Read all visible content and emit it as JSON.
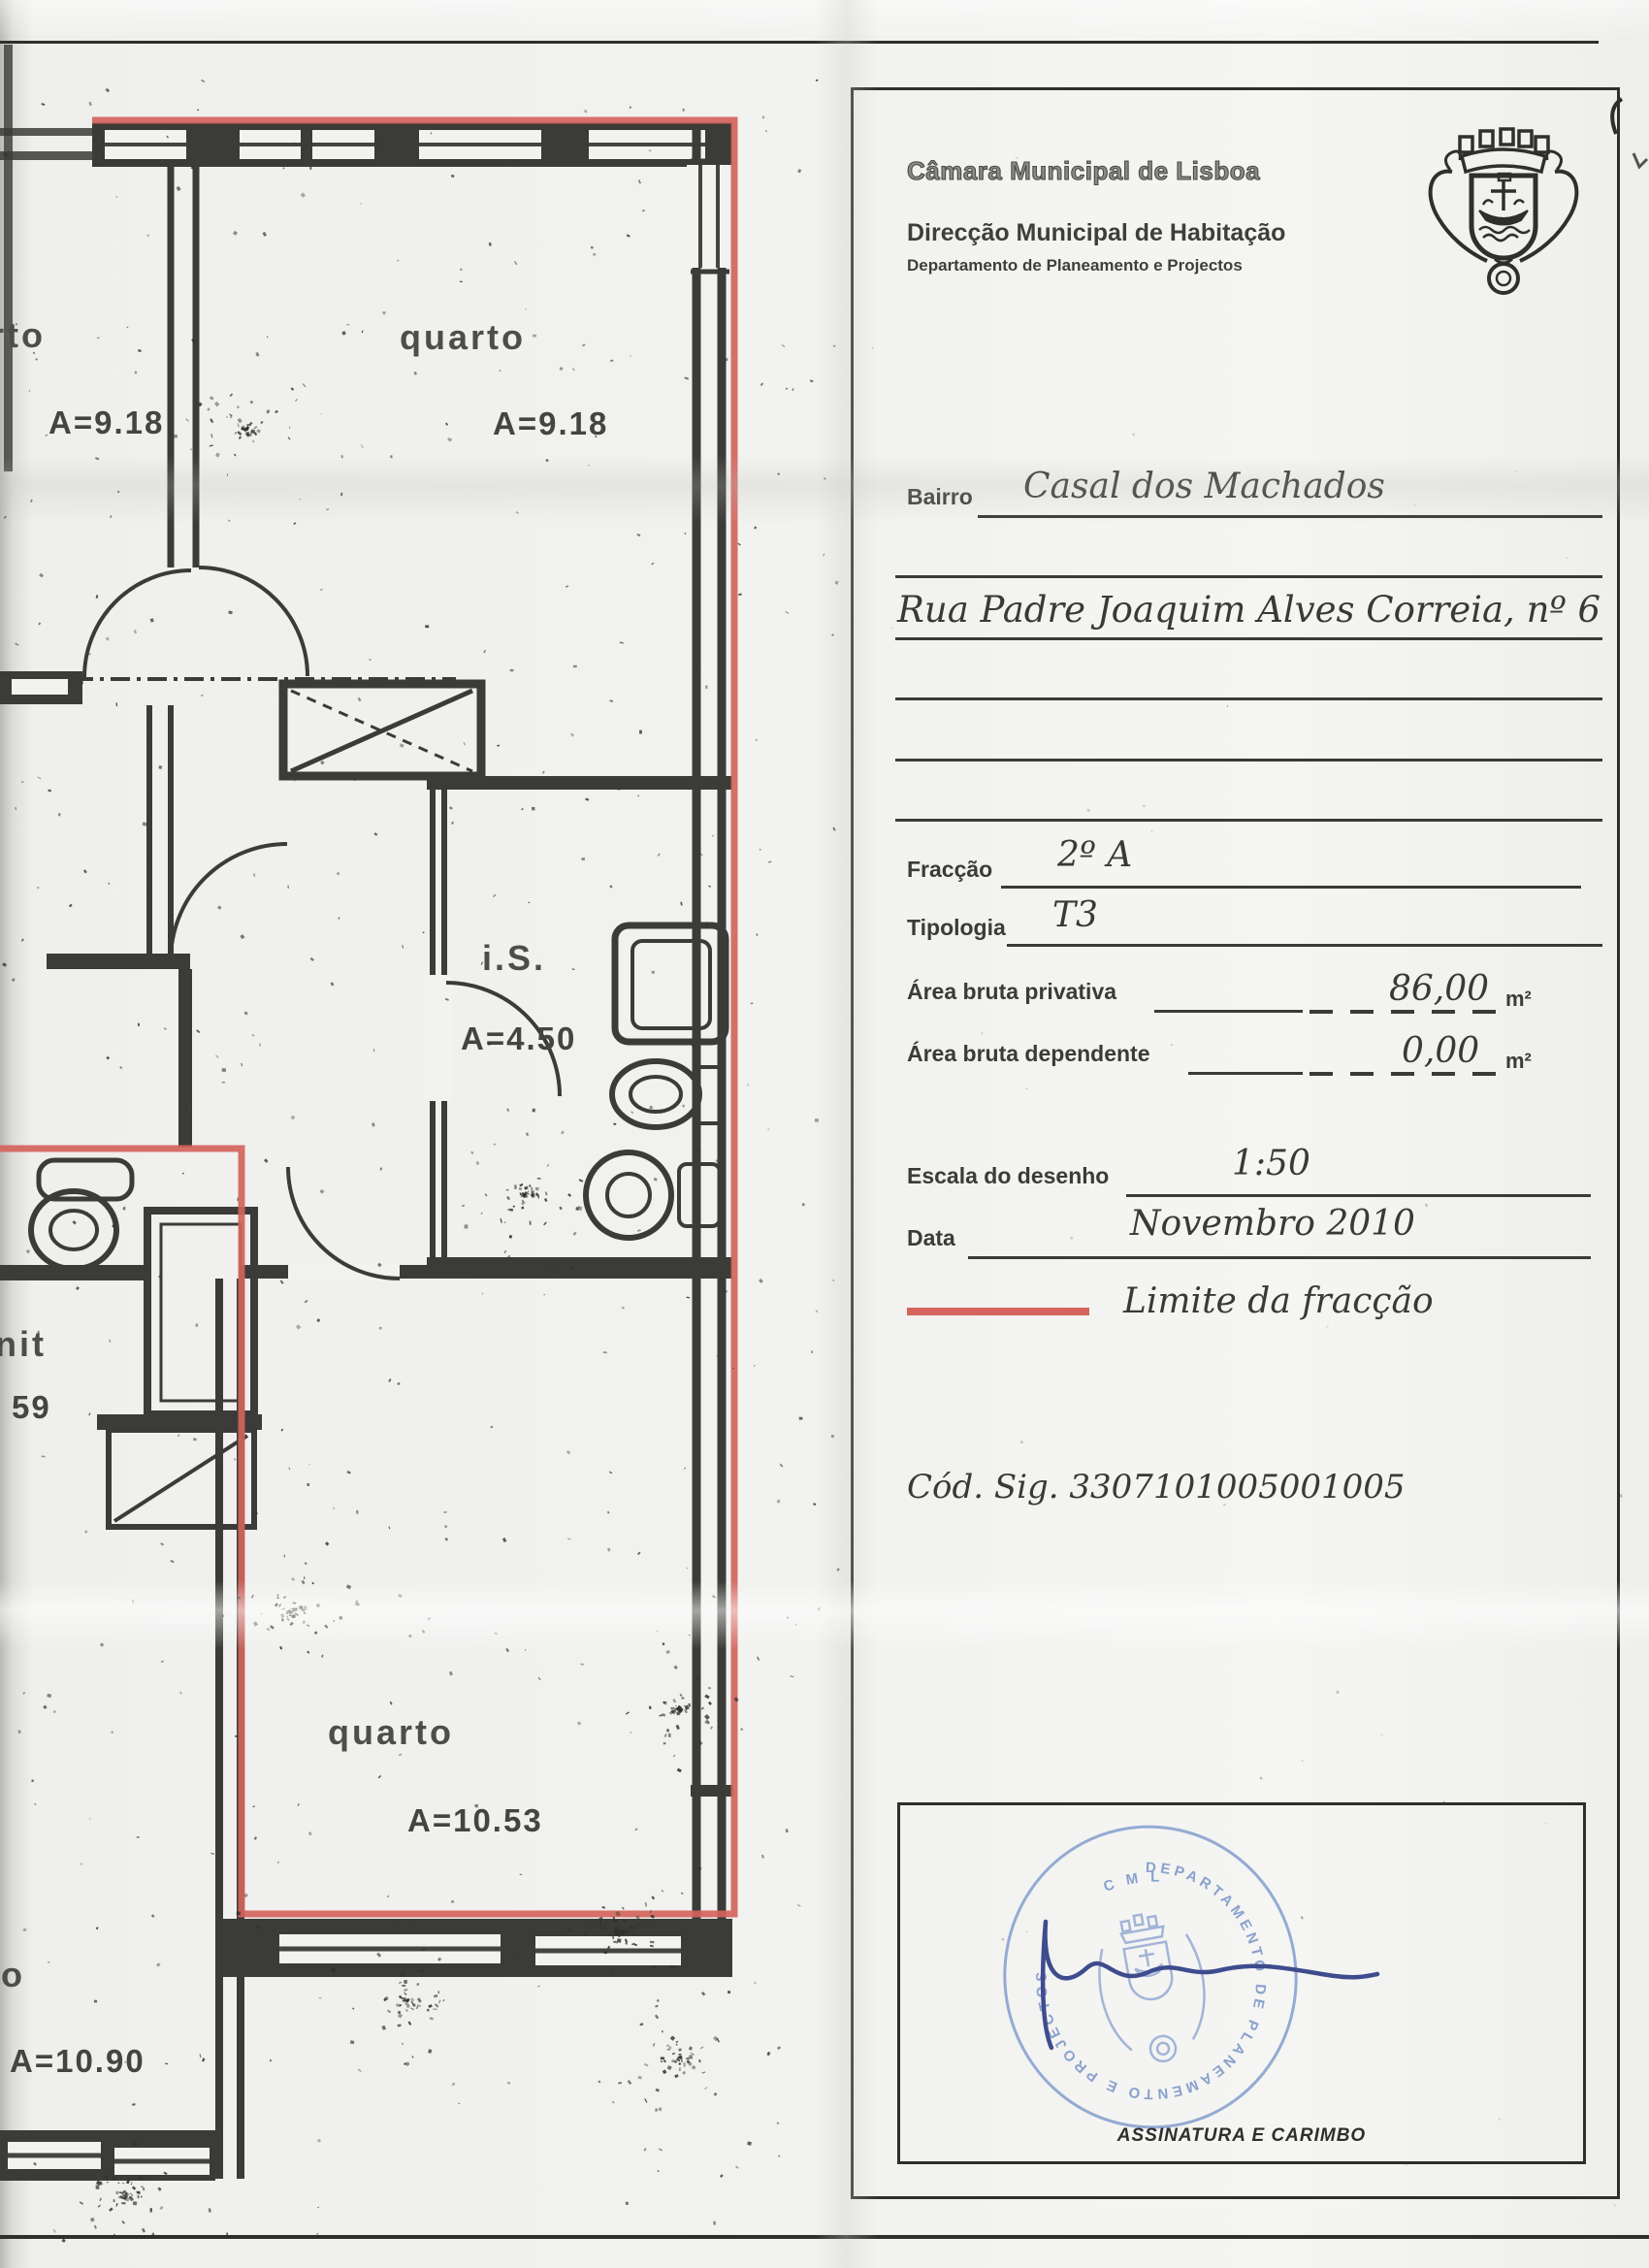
{
  "header": {
    "municipality": "Câmara Municipal de Lisboa",
    "direction": "Direcção Municipal de Habitação",
    "department": "Departamento de Planeamento e Projectos"
  },
  "form": {
    "bairro_label": "Bairro",
    "bairro_value": "Casal dos Machados",
    "address_value": "Rua Padre Joaquim Alves Correia, nº 6",
    "fraccao_label": "Fracção",
    "fraccao_value": "2º A",
    "tipologia_label": "Tipologia",
    "tipologia_value": "T3",
    "area_privativa_label": "Área bruta privativa",
    "area_privativa_value": "86,00",
    "area_privativa_unit": "m²",
    "area_dependente_label": "Área bruta dependente",
    "area_dependente_value": "0,00",
    "area_dependente_unit": "m²",
    "escala_label": "Escala do desenho",
    "escala_value": "1:50",
    "data_label": "Data",
    "data_value": "Novembro 2010",
    "legend_label": "Limite da fracção",
    "cod_sig": "Cód. Sig. 3307101005001005",
    "signature_caption": "ASSINATURA E CARIMBO"
  },
  "stamp": {
    "top_text": "C M L",
    "ring_text": "DEPARTAMENTO DE PLANEAMENTO E PROJECTOS"
  },
  "plan": {
    "room_top_left_fragment": "rto",
    "room_top_left_area": "A=9.18",
    "room_top_right": "quarto",
    "room_top_right_area": "A=9.18",
    "bathroom": "i.S.",
    "bathroom_area": "A=4.50",
    "neighbor_fragment_1": "anit",
    "neighbor_fragment_2": "59",
    "room_bottom": "quarto",
    "room_bottom_area": "A=10.53",
    "room_bottom_left_fragment": "to",
    "room_bottom_left_area": "A=10.90"
  },
  "colors": {
    "fraction_boundary": "#d4645c",
    "stamp_blue": "#8aa3cf",
    "signature_blue": "#3e4c8e",
    "wall_ink": "#3b3b37"
  }
}
